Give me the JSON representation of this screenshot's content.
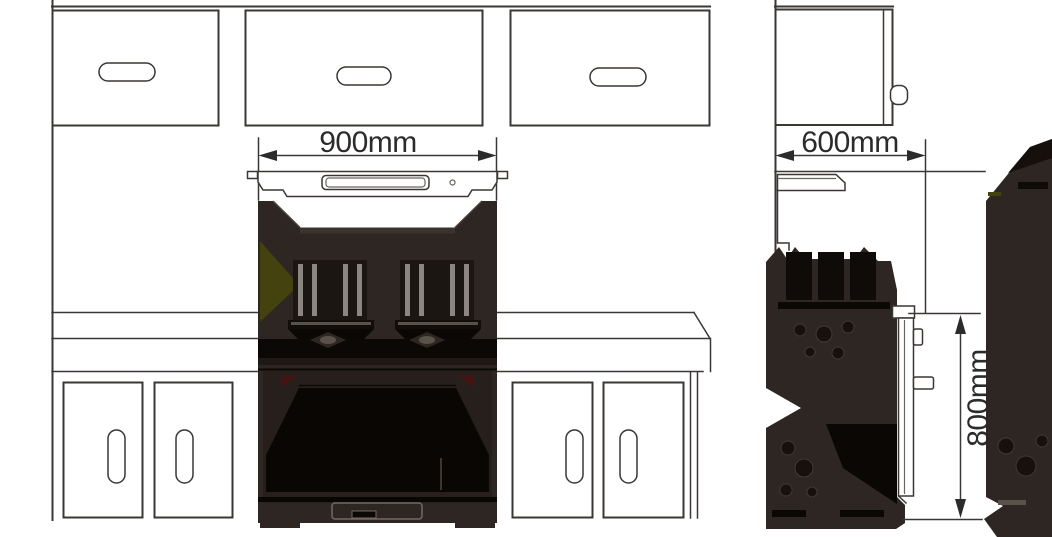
{
  "page": {
    "type": "appliance-installation-diagram",
    "background": "#ffffff"
  },
  "dimensions": {
    "front_width": {
      "value": "900",
      "unit": "mm"
    },
    "side_depth": {
      "value": "600",
      "unit": "mm"
    },
    "side_height": {
      "value": "800",
      "unit": "mm"
    }
  },
  "colors": {
    "line": "#3a3734",
    "cooker_body": "#2e2622",
    "cooker_black": "#0b0805",
    "accent_olive": "#44420f",
    "accent_red": "#431412",
    "metal_light": "#8c8680",
    "text": "#2b2b2b"
  }
}
